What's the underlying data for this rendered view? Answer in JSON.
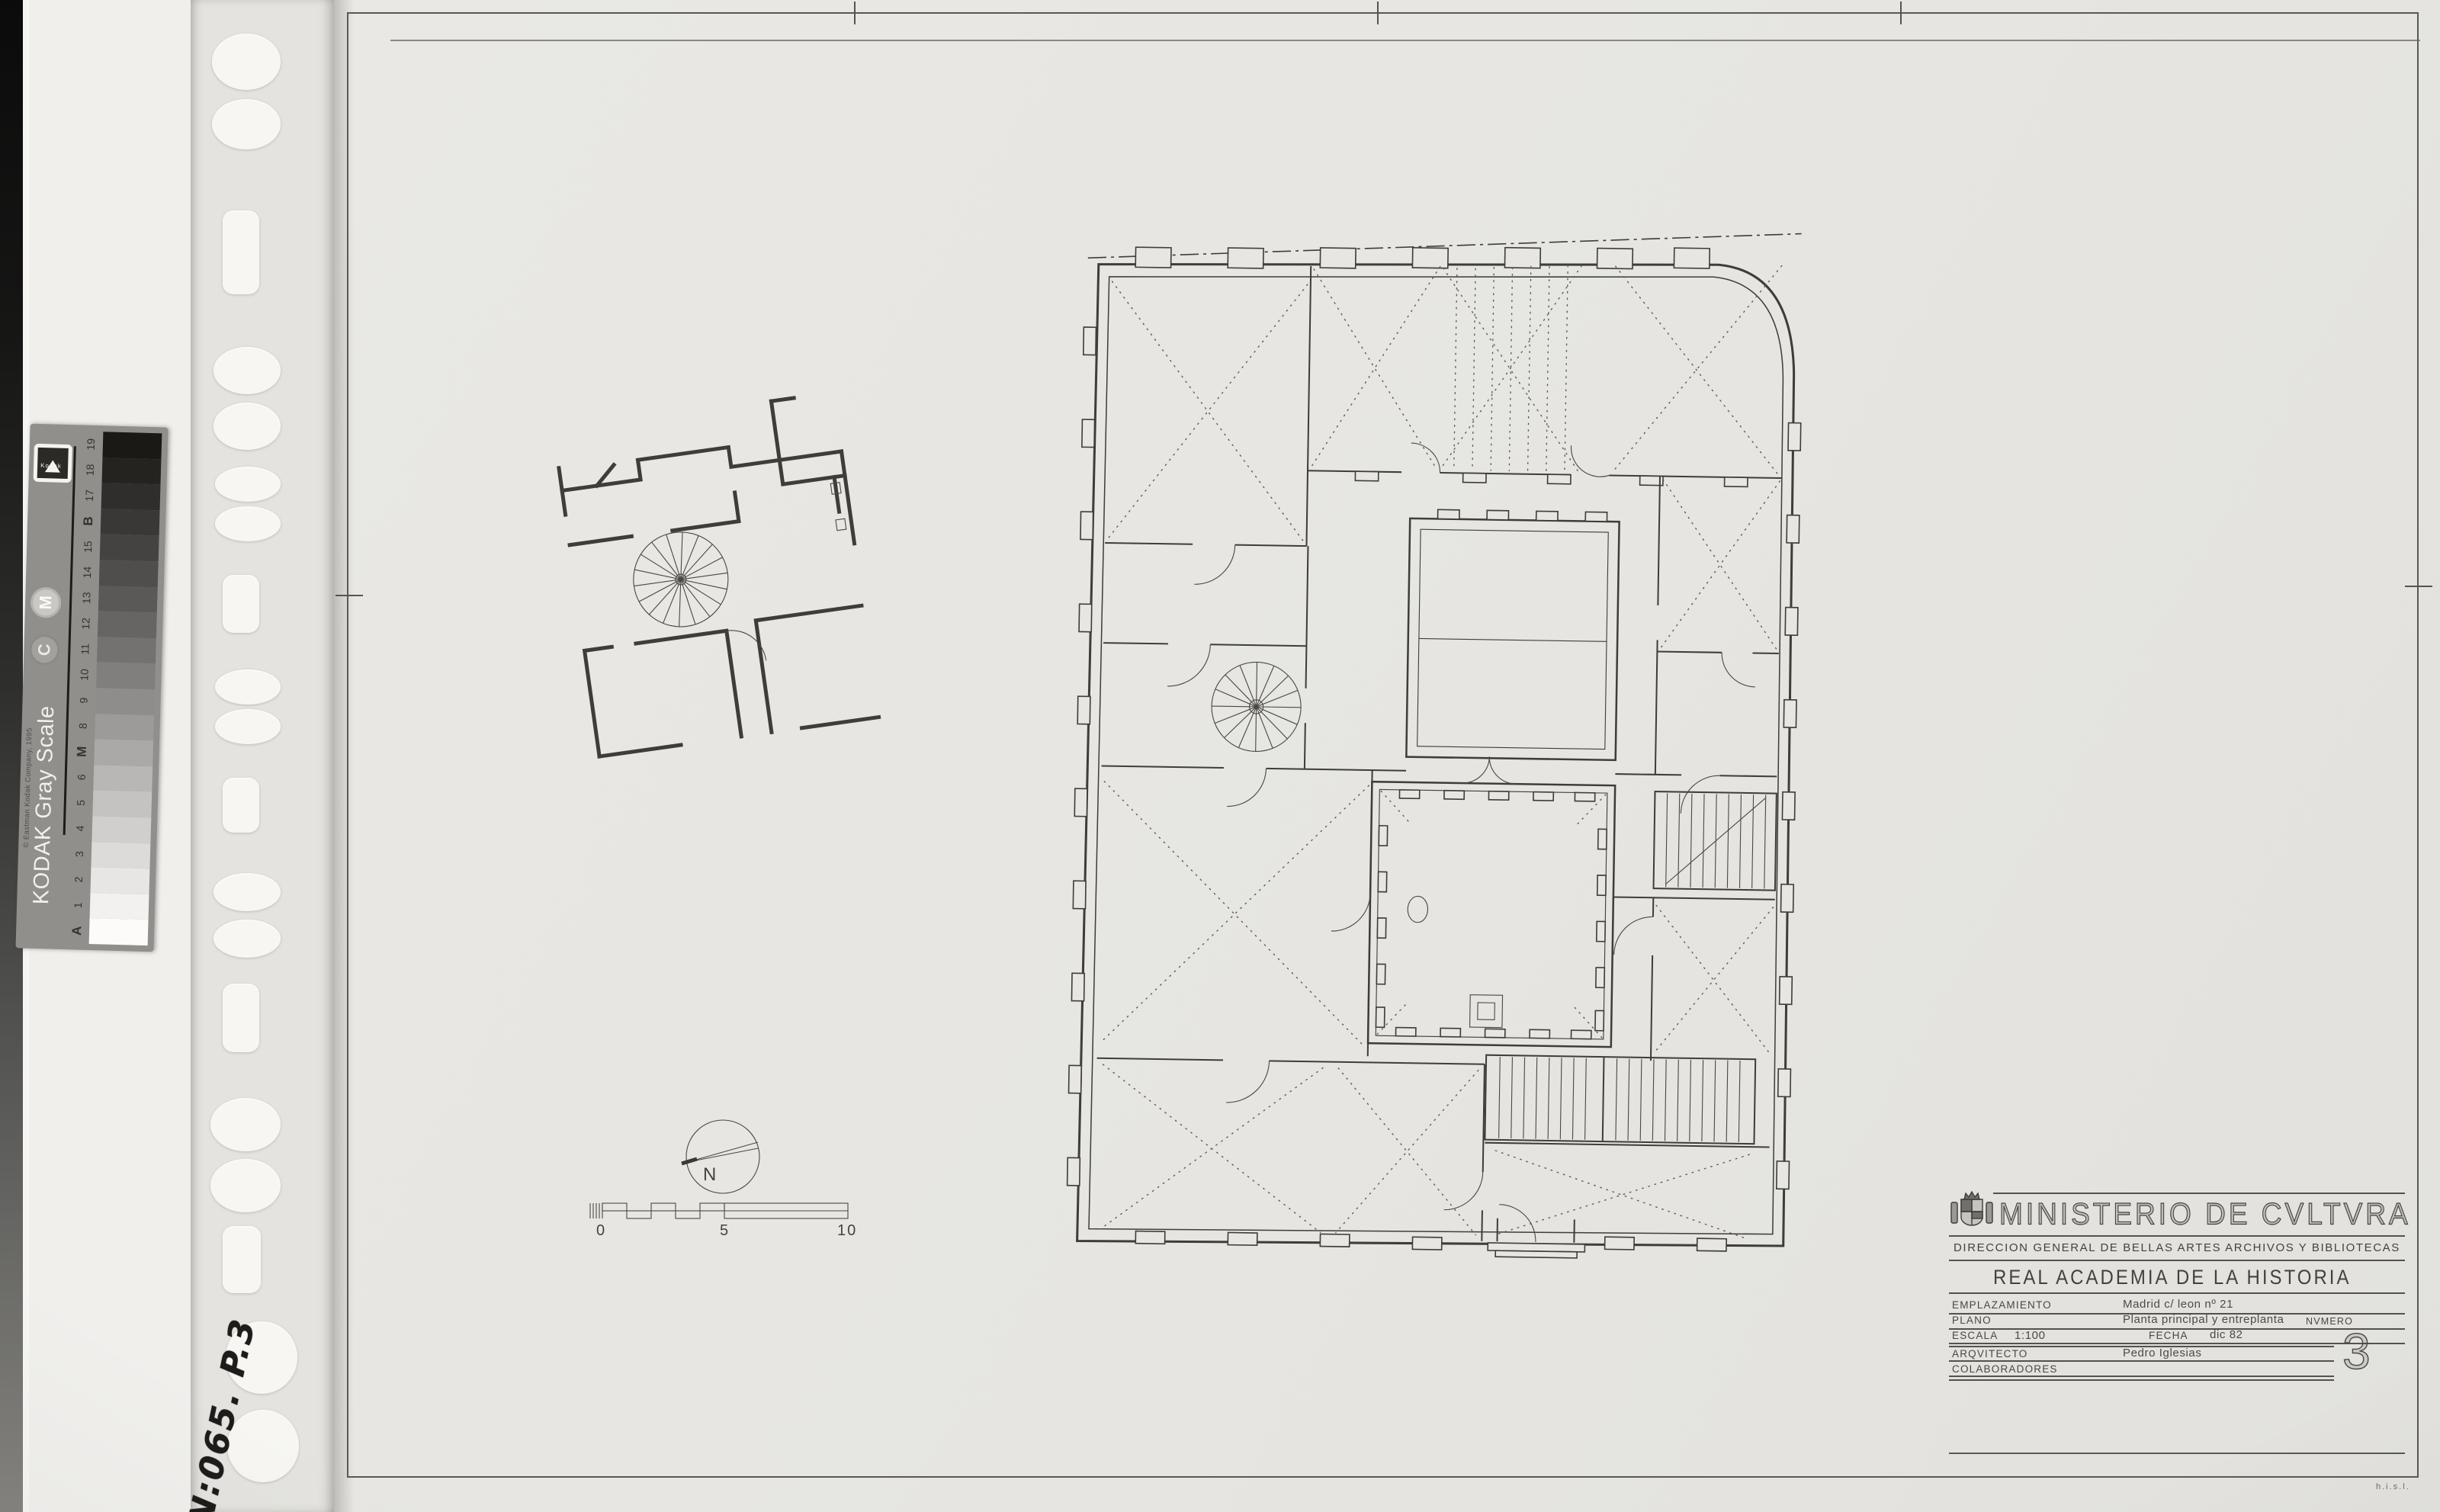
{
  "title_block": {
    "ministry": "MINISTERIO DE CVLTVRA",
    "department": "DIRECCION GENERAL DE BELLAS ARTES ARCHIVOS Y BIBLIOTECAS",
    "institution": "REAL ACADEMIA DE LA HISTORIA",
    "rows": {
      "emplazamiento": {
        "label": "EMPLAZAMIENTO",
        "value": "Madrid  c/ leon nº 21"
      },
      "plano": {
        "label": "PLANO",
        "value": "Planta principal y entreplanta",
        "numero_label": "NVMERO"
      },
      "escala": {
        "label": "ESCALA",
        "value": "1:100",
        "fecha_label": "FECHA",
        "fecha_value": "dic 82"
      },
      "arquitecto": {
        "label": "ARQVITECTO",
        "value": "Pedro Iglesias"
      },
      "colaboradores": {
        "label": "COLABORADORES"
      }
    },
    "sheet_number": "3"
  },
  "plan": {
    "north_label": "N",
    "scale_ticks": [
      "0",
      "5",
      "10"
    ]
  },
  "kodak": {
    "title": "KODAK Gray Scale",
    "copyright": "© Eastman Kodak Company, 1995",
    "mark_c": "C",
    "mark_m": "M",
    "logo": "Kodak",
    "steps": [
      {
        "label": "A",
        "color": "#fcfbf9",
        "strong": true
      },
      {
        "label": "1",
        "color": "#f2f1ef"
      },
      {
        "label": "2",
        "color": "#e7e6e4"
      },
      {
        "label": "3",
        "color": "#dcdbd9"
      },
      {
        "label": "4",
        "color": "#d0cfcd"
      },
      {
        "label": "5",
        "color": "#c4c3c1"
      },
      {
        "label": "6",
        "color": "#b8b7b5"
      },
      {
        "label": "M",
        "color": "#aaa9a7",
        "strong": true
      },
      {
        "label": "8",
        "color": "#9c9b99"
      },
      {
        "label": "9",
        "color": "#8e8d8b"
      },
      {
        "label": "10",
        "color": "#817f7d"
      },
      {
        "label": "11",
        "color": "#747270"
      },
      {
        "label": "12",
        "color": "#676563"
      },
      {
        "label": "13",
        "color": "#5a5957"
      },
      {
        "label": "14",
        "color": "#4f4e4c"
      },
      {
        "label": "15",
        "color": "#444341"
      },
      {
        "label": "B",
        "color": "#393836",
        "strong": true
      },
      {
        "label": "17",
        "color": "#2f2e2c"
      },
      {
        "label": "18",
        "color": "#242320"
      },
      {
        "label": "19",
        "color": "#1a1916"
      }
    ]
  },
  "annotations": {
    "sleeve_number": "N:065. P.3",
    "corner_mark": "h.i.s.l."
  }
}
